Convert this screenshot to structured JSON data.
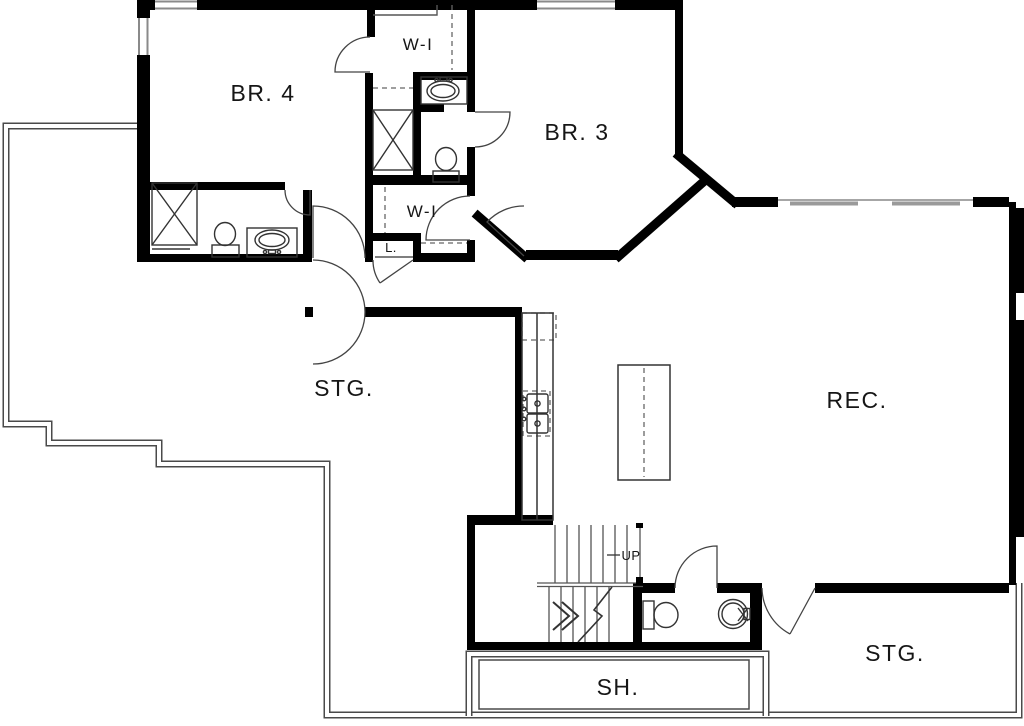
{
  "drawing_title": "Lower level floor plan",
  "rooms": {
    "br4": "BR. 4",
    "wi_top": "W-I",
    "br3": "BR. 3",
    "wi_mid": "W-I",
    "linen": "L.",
    "stg_left": "STG.",
    "rec": "REC.",
    "up": "UP",
    "sh": "SH.",
    "stg_right": "STG."
  },
  "colors": {
    "finished_wall": "#000000",
    "unfinished_wall": "#4a4a4a",
    "fixture_line": "#333333",
    "window_gray": "#999999",
    "background": "#ffffff"
  }
}
